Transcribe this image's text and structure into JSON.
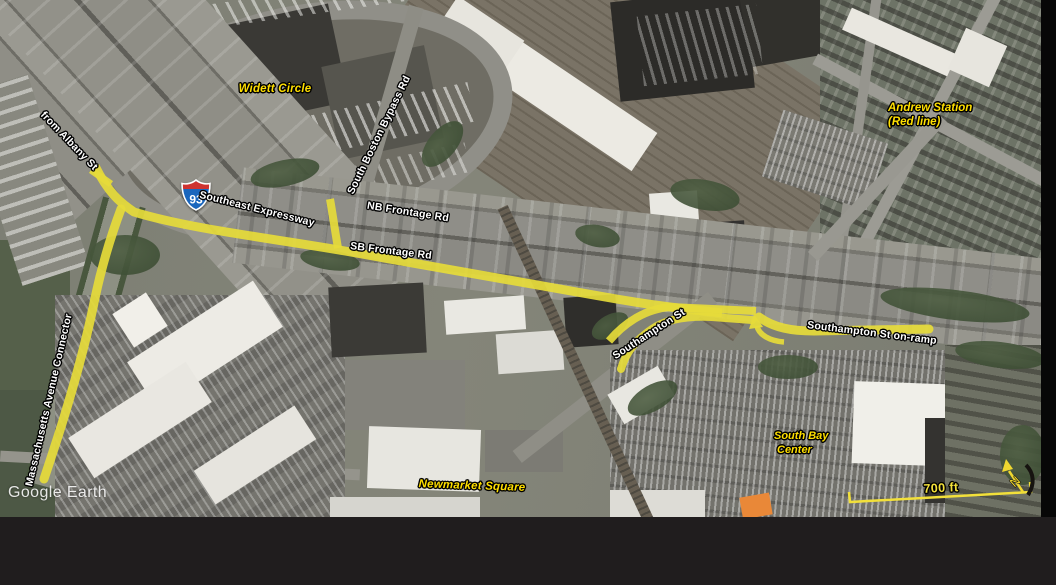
{
  "watermark": {
    "text": "Google Earth"
  },
  "shield": {
    "type": "Interstate",
    "number": "93"
  },
  "scale_bar": {
    "label": "700 ft"
  },
  "north_arrow": {
    "label": "N"
  },
  "roads": {
    "from_albany": "from Albany St",
    "southeast_expressway": "Southeast Expressway",
    "nb_frontage": "NB Frontage Rd",
    "sb_frontage": "SB Frontage Rd",
    "south_boston_bypass": "South Boston Bypass Rd",
    "southampton": "Southampton St",
    "southampton_onramp": "Southampton St on-ramp",
    "mass_ave_connector": "Massachusetts Avenue Connector"
  },
  "places": {
    "widett_circle": "Widett Circle",
    "andrew_station_line1": "Andrew Station",
    "andrew_station_line2": "(Red line)",
    "south_bay_line1": "South Bay",
    "south_bay_line2": "Center",
    "newmarket_square": "Newmarket Square"
  },
  "colors": {
    "route_highlight": "#e6db3a",
    "place_label": "#ffdf00",
    "road_label": "#ffffff",
    "scale_bar": "#f2e03a",
    "shield_blue": "#1a66bd",
    "shield_red": "#ce3330",
    "letterbox_bottom": "#201d1e",
    "letterbox_right": "#070707"
  }
}
